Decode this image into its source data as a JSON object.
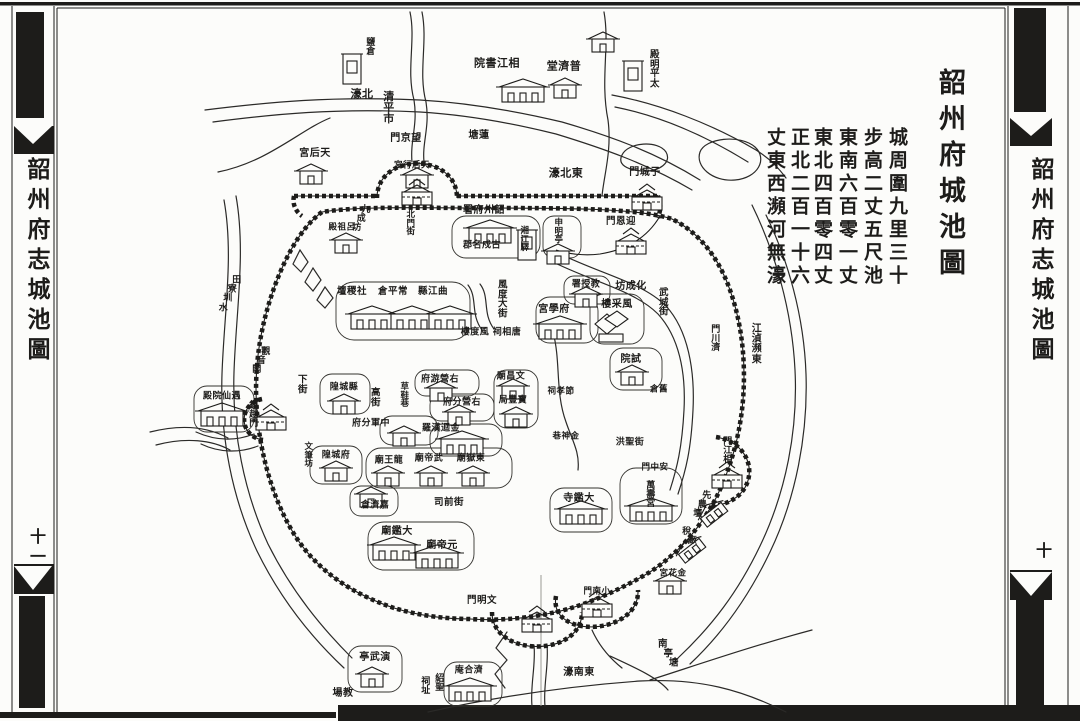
{
  "page": {
    "sheet_title": "韶州府城池圖",
    "description_columns": [
      "城周圍九里三十",
      "步高二丈五尺池",
      "東南六百零一丈",
      "東北四百零四丈",
      "正北二百一十六",
      "丈東西瀕河無濠"
    ],
    "margins": {
      "left": {
        "title": "韶州府志城池圖",
        "page_number": "十一"
      },
      "right": {
        "title": "韶州府志城池圖",
        "page_number": "十"
      }
    },
    "colors": {
      "ink": "#1d1c1a",
      "paper": "#fcfcfa"
    }
  },
  "map": {
    "labels": [
      {
        "t": "鹽倉",
        "x": 371,
        "y": 48,
        "o": "v",
        "fs": 9
      },
      {
        "t": "清平市",
        "x": 389,
        "y": 108,
        "o": "v",
        "fs": 11
      },
      {
        "t": "相江書院",
        "x": 497,
        "y": 63,
        "o": "h",
        "fs": 11
      },
      {
        "t": "普濟堂",
        "x": 564,
        "y": 66,
        "o": "h",
        "fs": 11
      },
      {
        "t": "太平明殿",
        "x": 655,
        "y": 70,
        "o": "vu",
        "fs": 9.5
      },
      {
        "t": "蓮塘",
        "x": 479,
        "y": 136,
        "o": "h",
        "fs": 10
      },
      {
        "t": "北濠",
        "x": 362,
        "y": 94,
        "o": "h",
        "fs": 11
      },
      {
        "t": "東北濠",
        "x": 566,
        "y": 173,
        "o": "h",
        "fs": 11
      },
      {
        "t": "子城門",
        "x": 645,
        "y": 173,
        "o": "h",
        "fs": 10
      },
      {
        "t": "望京門",
        "x": 406,
        "y": 139,
        "o": "h",
        "fs": 10
      },
      {
        "t": "天后行宮",
        "x": 412,
        "y": 166,
        "o": "h",
        "fs": 8.5
      },
      {
        "t": "天后宮",
        "x": 315,
        "y": 154,
        "o": "h",
        "fs": 10
      },
      {
        "t": "迎恩門",
        "x": 621,
        "y": 222,
        "o": "h",
        "fs": 9.5
      },
      {
        "t": "申明亭",
        "x": 559,
        "y": 232,
        "o": "v",
        "fs": 8.5
      },
      {
        "t": "韶州府署",
        "x": 484,
        "y": 211,
        "o": "h",
        "fs": 10
      },
      {
        "t": "古戍名郡",
        "x": 482,
        "y": 246,
        "o": "h",
        "fs": 9
      },
      {
        "t": "湘江驛",
        "x": 525,
        "y": 240,
        "o": "v",
        "fs": 8.5
      },
      {
        "t": "九成坊",
        "x": 366,
        "y": 220,
        "o": "d",
        "fs": 9
      },
      {
        "t": "呂祖殿",
        "x": 342,
        "y": 228,
        "o": "h",
        "fs": 8.5
      },
      {
        "t": "北門街",
        "x": 411,
        "y": 224,
        "o": "v",
        "fs": 8.5
      },
      {
        "t": "社稷壇",
        "x": 352,
        "y": 292,
        "o": "h",
        "fs": 9.5
      },
      {
        "t": "常平倉",
        "x": 393,
        "y": 292,
        "o": "h",
        "fs": 9.5
      },
      {
        "t": "曲江縣",
        "x": 433,
        "y": 292,
        "o": "h",
        "fs": 9.5
      },
      {
        "t": "風度大街",
        "x": 503,
        "y": 300,
        "o": "v",
        "fs": 9.5
      },
      {
        "t": "風度樓",
        "x": 475,
        "y": 333,
        "o": "h",
        "fs": 9
      },
      {
        "t": "唐相祠",
        "x": 507,
        "y": 333,
        "o": "h",
        "fs": 9
      },
      {
        "t": "縣城隍",
        "x": 344,
        "y": 388,
        "o": "h",
        "fs": 9
      },
      {
        "t": "高街",
        "x": 376,
        "y": 398,
        "o": "v",
        "fs": 9.5
      },
      {
        "t": "下街",
        "x": 303,
        "y": 385,
        "o": "v",
        "fs": 9.5
      },
      {
        "t": "草鞋巷",
        "x": 405,
        "y": 396,
        "o": "v",
        "fs": 8.5
      },
      {
        "t": "右營游府",
        "x": 440,
        "y": 380,
        "o": "h",
        "fs": 9
      },
      {
        "t": "右營分府",
        "x": 462,
        "y": 403,
        "o": "h",
        "fs": 9
      },
      {
        "t": "中軍分府",
        "x": 371,
        "y": 424,
        "o": "h",
        "fs": 9
      },
      {
        "t": "羅漢迴金",
        "x": 441,
        "y": 429,
        "o": "hl",
        "fs": 9
      },
      {
        "t": "文昌廟",
        "x": 511,
        "y": 377,
        "o": "h",
        "fs": 9
      },
      {
        "t": "寶豐局",
        "x": 513,
        "y": 401,
        "o": "h",
        "fs": 9
      },
      {
        "t": "節孝祠",
        "x": 561,
        "y": 392,
        "o": "h",
        "fs": 8.5
      },
      {
        "t": "東嶽廟",
        "x": 471,
        "y": 459,
        "o": "h",
        "fs": 9
      },
      {
        "t": "武帝廟",
        "x": 429,
        "y": 459,
        "o": "h",
        "fs": 9
      },
      {
        "t": "龍王廟",
        "x": 389,
        "y": 461,
        "o": "h",
        "fs": 9
      },
      {
        "t": "司前街",
        "x": 449,
        "y": 503,
        "o": "hl",
        "fs": 9.5
      },
      {
        "t": "府城隍",
        "x": 336,
        "y": 456,
        "o": "h",
        "fs": 9
      },
      {
        "t": "文筆坊",
        "x": 309,
        "y": 456,
        "o": "v",
        "fs": 8.5
      },
      {
        "t": "嘉濟倉",
        "x": 375,
        "y": 506,
        "o": "h",
        "fs": 9
      },
      {
        "t": "大鑑廟",
        "x": 397,
        "y": 532,
        "o": "h",
        "fs": 10
      },
      {
        "t": "元帝廟",
        "x": 442,
        "y": 546,
        "o": "h",
        "fs": 10
      },
      {
        "t": "演武亭",
        "x": 375,
        "y": 658,
        "o": "h",
        "fs": 10
      },
      {
        "t": "教場",
        "x": 343,
        "y": 694,
        "o": "h",
        "fs": 10
      },
      {
        "t": "文明門",
        "x": 482,
        "y": 601,
        "o": "h",
        "fs": 9.5
      },
      {
        "t": "小南門",
        "x": 597,
        "y": 592,
        "o": "h",
        "fs": 8.5
      },
      {
        "t": "紹聖",
        "x": 440,
        "y": 684,
        "o": "v",
        "fs": 9
      },
      {
        "t": "祠址",
        "x": 426,
        "y": 687,
        "o": "v",
        "fs": 9
      },
      {
        "t": "濟合庵",
        "x": 469,
        "y": 671,
        "o": "h",
        "fs": 9
      },
      {
        "t": "東南濠",
        "x": 579,
        "y": 673,
        "o": "h",
        "fs": 10
      },
      {
        "t": "南亭塘",
        "x": 663,
        "y": 654,
        "o": "d2",
        "fs": 9.5
      },
      {
        "t": "東瀕湞江",
        "x": 757,
        "y": 345,
        "o": "vu",
        "fs": 10
      },
      {
        "t": "相江門",
        "x": 728,
        "y": 452,
        "o": "vu",
        "fs": 9
      },
      {
        "t": "濟川門",
        "x": 716,
        "y": 340,
        "o": "vu",
        "fs": 9
      },
      {
        "t": "先農壇",
        "x": 707,
        "y": 506,
        "o": "d",
        "fs": 9
      },
      {
        "t": "稅廠",
        "x": 687,
        "y": 537,
        "o": "d2",
        "fs": 9
      },
      {
        "t": "金花宮",
        "x": 673,
        "y": 574,
        "o": "h",
        "fs": 8.5
      },
      {
        "t": "金神巷",
        "x": 566,
        "y": 437,
        "o": "h",
        "fs": 8.5
      },
      {
        "t": "洪聖街",
        "x": 630,
        "y": 443,
        "o": "hl",
        "fs": 9
      },
      {
        "t": "安中門",
        "x": 655,
        "y": 468,
        "o": "h",
        "fs": 8.5
      },
      {
        "t": "萬壽宮",
        "x": 651,
        "y": 496,
        "o": "v",
        "fs": 9
      },
      {
        "t": "大鑑寺",
        "x": 579,
        "y": 499,
        "o": "h",
        "fs": 10
      },
      {
        "t": "試院",
        "x": 631,
        "y": 360,
        "o": "h",
        "fs": 10
      },
      {
        "t": "舊倉",
        "x": 659,
        "y": 390,
        "o": "h",
        "fs": 8.5
      },
      {
        "t": "化成坊",
        "x": 631,
        "y": 287,
        "o": "h",
        "fs": 10
      },
      {
        "t": "武城街",
        "x": 664,
        "y": 303,
        "o": "v",
        "fs": 9.5
      },
      {
        "t": "教授署",
        "x": 586,
        "y": 285,
        "o": "h",
        "fs": 9
      },
      {
        "t": "府學宮",
        "x": 554,
        "y": 310,
        "o": "h",
        "fs": 10
      },
      {
        "t": "風采樓",
        "x": 617,
        "y": 305,
        "o": "h",
        "fs": 10
      },
      {
        "t": "觀音閣",
        "x": 266,
        "y": 362,
        "o": "d",
        "fs": 9
      },
      {
        "t": "鎮越門",
        "x": 254,
        "y": 416,
        "o": "v",
        "fs": 9
      },
      {
        "t": "遇仙院殿",
        "x": 222,
        "y": 397,
        "o": "h",
        "fs": 9
      },
      {
        "t": "田寮圳水",
        "x": 237,
        "y": 295,
        "o": "d",
        "fs": 9
      }
    ],
    "buildings": [
      {
        "type": "tall",
        "x": 352,
        "y": 70
      },
      {
        "type": "hall",
        "x": 523,
        "y": 91
      },
      {
        "type": "house",
        "x": 565,
        "y": 88
      },
      {
        "type": "tall",
        "x": 633,
        "y": 77
      },
      {
        "type": "house",
        "x": 603,
        "y": 42
      },
      {
        "type": "house",
        "x": 311,
        "y": 174
      },
      {
        "type": "house",
        "x": 417,
        "y": 178
      },
      {
        "type": "tower",
        "x": 647,
        "y": 199
      },
      {
        "type": "tower",
        "x": 631,
        "y": 243
      },
      {
        "type": "hall",
        "x": 490,
        "y": 232
      },
      {
        "type": "tall",
        "x": 527,
        "y": 246
      },
      {
        "type": "house",
        "x": 558,
        "y": 254
      },
      {
        "type": "house",
        "x": 346,
        "y": 243
      },
      {
        "type": "hall",
        "x": 372,
        "y": 318
      },
      {
        "type": "hall",
        "x": 412,
        "y": 318
      },
      {
        "type": "hall",
        "x": 450,
        "y": 318
      },
      {
        "type": "house",
        "x": 344,
        "y": 404
      },
      {
        "type": "house",
        "x": 336,
        "y": 471
      },
      {
        "type": "house",
        "x": 441,
        "y": 391
      },
      {
        "type": "house",
        "x": 459,
        "y": 415
      },
      {
        "type": "house",
        "x": 404,
        "y": 436
      },
      {
        "type": "hall",
        "x": 462,
        "y": 443
      },
      {
        "type": "house",
        "x": 516,
        "y": 417
      },
      {
        "type": "house",
        "x": 586,
        "y": 297
      },
      {
        "type": "hall",
        "x": 560,
        "y": 328
      },
      {
        "type": "fengcai",
        "x": 609,
        "y": 326
      },
      {
        "type": "house",
        "x": 632,
        "y": 375
      },
      {
        "type": "house",
        "x": 371,
        "y": 497
      },
      {
        "type": "house",
        "x": 388,
        "y": 476
      },
      {
        "type": "house",
        "x": 431,
        "y": 476
      },
      {
        "type": "house",
        "x": 473,
        "y": 476
      },
      {
        "type": "hall",
        "x": 651,
        "y": 510
      },
      {
        "type": "hall",
        "x": 581,
        "y": 513
      },
      {
        "type": "hall",
        "x": 394,
        "y": 549
      },
      {
        "type": "hall",
        "x": 437,
        "y": 557
      },
      {
        "type": "hall",
        "x": 222,
        "y": 415
      },
      {
        "type": "house",
        "x": 372,
        "y": 677
      },
      {
        "type": "hall",
        "x": 470,
        "y": 690
      },
      {
        "type": "slant",
        "x": 712,
        "y": 512
      },
      {
        "type": "slant",
        "x": 690,
        "y": 548
      },
      {
        "type": "house",
        "x": 670,
        "y": 584
      },
      {
        "type": "house",
        "x": 513,
        "y": 389
      },
      {
        "type": "tower",
        "x": 537,
        "y": 621
      },
      {
        "type": "tower",
        "x": 597,
        "y": 606
      },
      {
        "type": "tower",
        "x": 727,
        "y": 477
      },
      {
        "type": "tower",
        "x": 271,
        "y": 419
      },
      {
        "type": "tower",
        "x": 417,
        "y": 194
      }
    ]
  }
}
